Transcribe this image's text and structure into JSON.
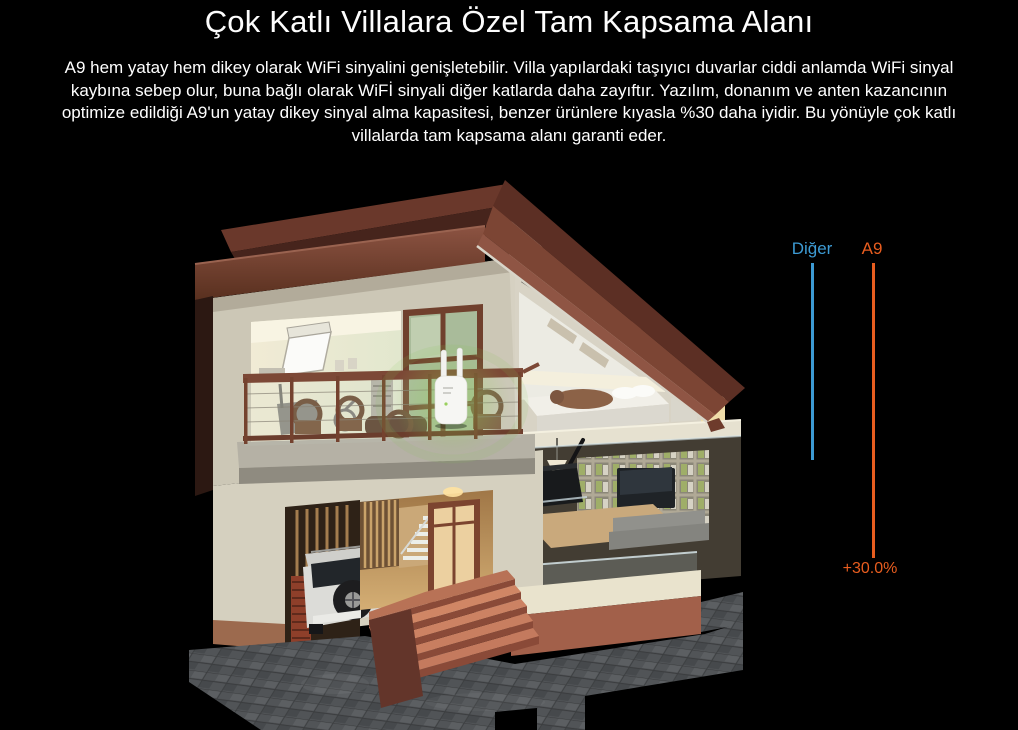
{
  "page": {
    "background": "#000000"
  },
  "header": {
    "title": "Çok Katlı Villalara Özel Tam Kapsama Alanı",
    "description": "A9 hem yatay hem dikey olarak WiFi sinyalini genişletebilir. Villa yapılardaki taşıyıcı duvarlar ciddi anlamda WiFi sinyal kaybına sebep olur, buna bağlı olarak WiFİ sinyali diğer katlarda daha zayıftır. Yazılım, donanım ve anten kazancının optimize edildiği A9'un yatay dikey sinyal alma kapasitesi, benzer ürünlere kıyasla %30 daha iyidir. Bu yönüyle çok katlı villalarda tam kapsama alanı garanti eder."
  },
  "comparison": {
    "competitor": {
      "label": "Diğer",
      "color": "#3d9bd4",
      "line_px": 197
    },
    "product": {
      "label": "A9",
      "color": "#e85d1f",
      "line_px": 295
    },
    "gain": "+30.0%"
  },
  "illustration": {
    "type": "3d-villa-cutaway-night-render",
    "elements": [
      "roof",
      "gym-room",
      "balcony",
      "wifi-extender",
      "bedroom",
      "garage",
      "suv",
      "staircase",
      "front-door",
      "entry-steps",
      "living-room",
      "router",
      "tv",
      "bookshelf",
      "sofa",
      "tiled-forecourt"
    ],
    "colors": {
      "roof": "#6e3b2d",
      "wall": "#d5d0bf",
      "interior_light": "#f2ecd8",
      "terracotta": "#a2604a",
      "ground_tile": "#54575a",
      "signal_glow": "#7cc24a"
    }
  }
}
